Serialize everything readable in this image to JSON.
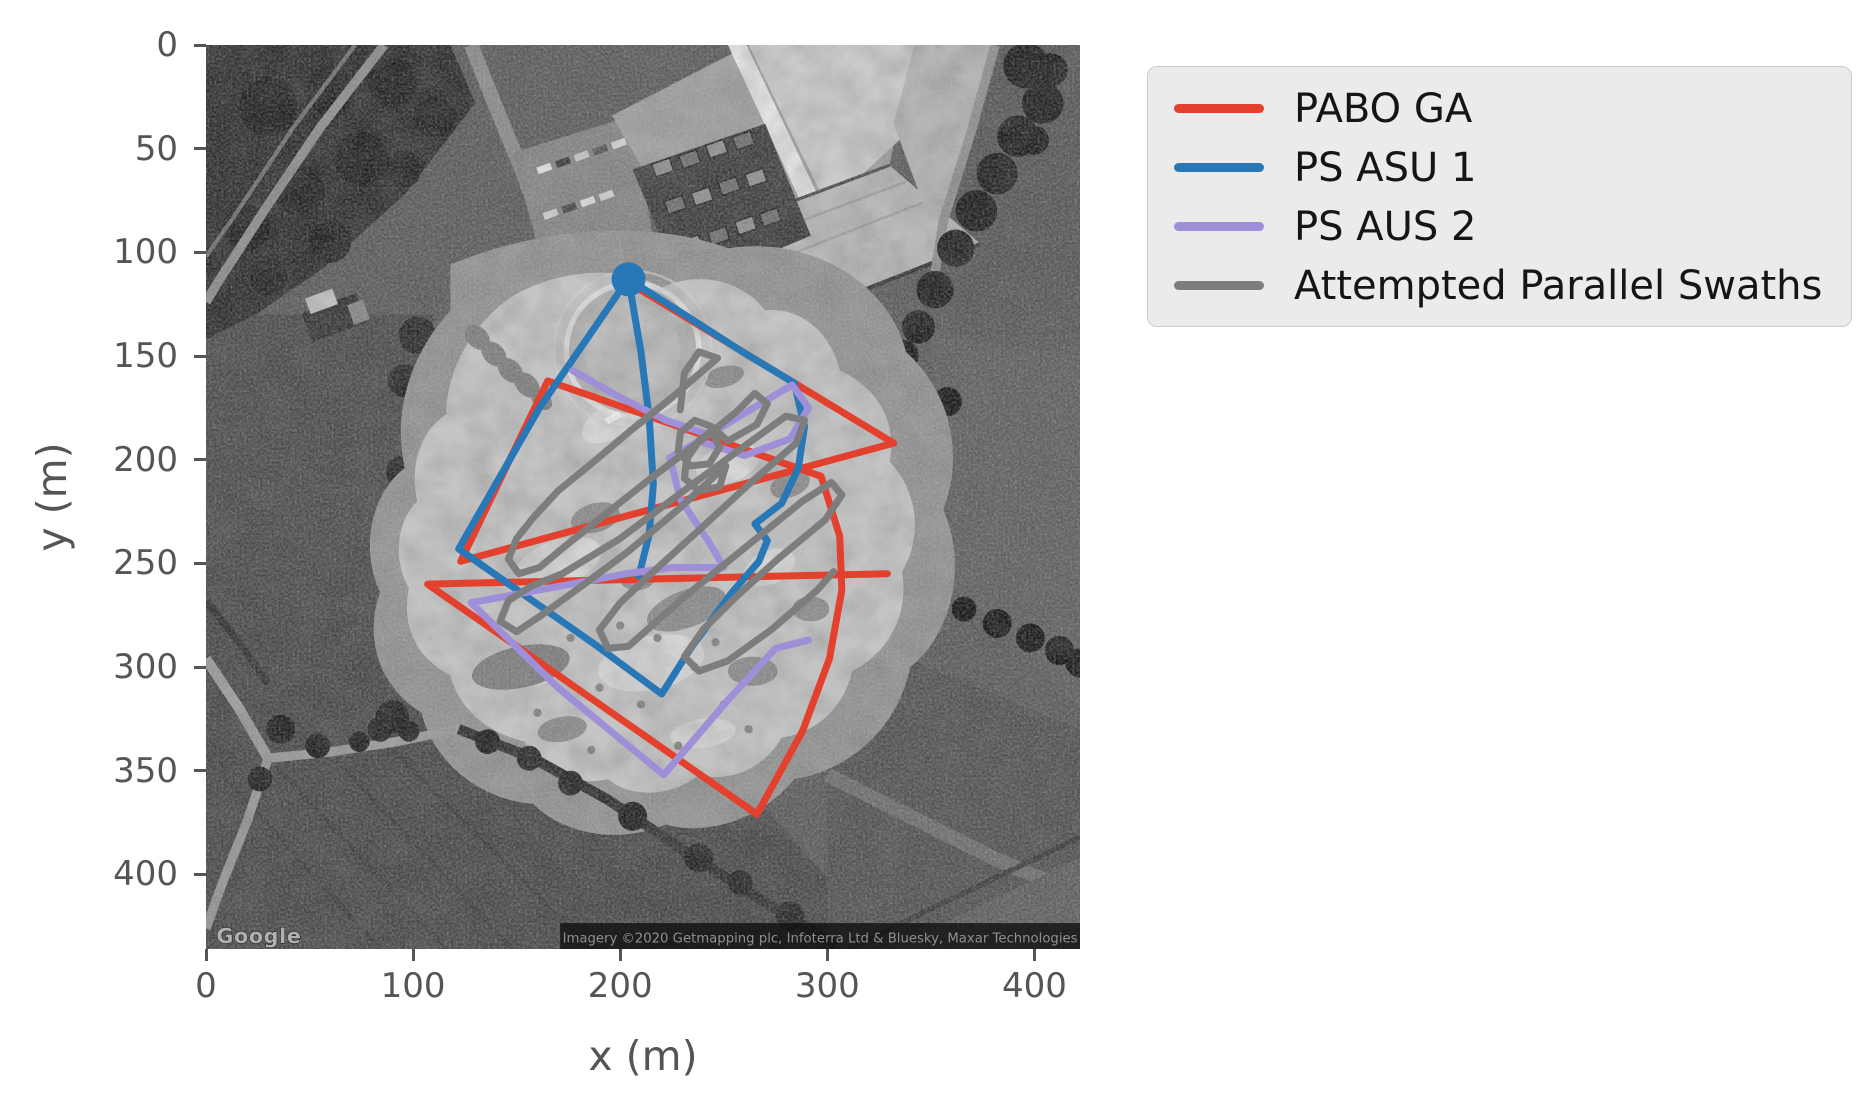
{
  "figure": {
    "background": "#ffffff",
    "axes": {
      "xlabel": "x (m)",
      "ylabel": "y (m)",
      "x_ticks": [
        0,
        100,
        200,
        300,
        400
      ],
      "y_ticks": [
        0,
        50,
        100,
        150,
        200,
        250,
        300,
        350,
        400
      ],
      "tick_color": "#555555",
      "tick_fontsize_px": 34,
      "axis_label_fontsize_px": 41
    }
  },
  "map_overlay": {
    "watermark": "Google",
    "attribution": "Imagery ©2020 Getmapping plc, Infoterra Ltd & Bluesky, Maxar Technologies"
  },
  "legend": {
    "background": "#ebebeb",
    "border_color": "#cccccc",
    "text_color": "#151515",
    "entries": [
      {
        "label": "PABO GA",
        "color": "#e3402e"
      },
      {
        "label": "PS ASU 1",
        "color": "#2878b8"
      },
      {
        "label": "PS AUS 2",
        "color": "#9f8fd8"
      },
      {
        "label": "Attempted Parallel Swaths",
        "color": "#7d7d7d"
      }
    ]
  },
  "chart_data": {
    "type": "line",
    "title": "",
    "xlabel": "x (m)",
    "ylabel": "y (m)",
    "xlim": [
      0,
      422
    ],
    "ylim": [
      0,
      436
    ],
    "y_axis_inverted": true,
    "grid": false,
    "legend_position": "outside upper right",
    "background": "grayscale satellite image of quarry test field (Google, Imagery ©2020)",
    "start_marker": {
      "series": "PS ASU 1",
      "x": 204,
      "y": 113,
      "radius_px": 17,
      "color": "#2878b8"
    },
    "series": [
      {
        "name": "PABO GA",
        "color": "#e3402e",
        "linewidth_px": 7,
        "points": [
          [
            203,
            114
          ],
          [
            332,
            192
          ],
          [
            123,
            249
          ],
          [
            165,
            162
          ],
          [
            297,
            208
          ],
          [
            306,
            237
          ],
          [
            307,
            263
          ],
          [
            301,
            296
          ],
          [
            288,
            331
          ],
          [
            266,
            371
          ],
          [
            107,
            260
          ],
          [
            329,
            255
          ]
        ]
      },
      {
        "name": "PS ASU 1",
        "color": "#2878b8",
        "linewidth_px": 7,
        "points": [
          [
            209,
            256
          ],
          [
            214,
            236
          ],
          [
            216,
            212
          ],
          [
            214,
            180
          ],
          [
            210,
            148
          ],
          [
            204,
            113
          ],
          [
            231,
            130
          ],
          [
            259,
            148
          ],
          [
            284,
            163
          ],
          [
            289,
            184
          ],
          [
            286,
            204
          ],
          [
            278,
            221
          ],
          [
            265,
            231
          ],
          [
            271,
            239
          ],
          [
            267,
            249
          ],
          [
            254,
            264
          ],
          [
            234,
            291
          ],
          [
            220,
            313
          ],
          [
            189,
            290
          ],
          [
            122,
            243
          ],
          [
            161,
            175
          ],
          [
            203,
            114
          ]
        ]
      },
      {
        "name": "PS AUS 2",
        "color": "#9f8fd8",
        "linewidth_px": 7,
        "points": [
          [
            177,
            157
          ],
          [
            200,
            170
          ],
          [
            222,
            181
          ],
          [
            243,
            188
          ],
          [
            266,
            174
          ],
          [
            283,
            164
          ],
          [
            291,
            175
          ],
          [
            282,
            190
          ],
          [
            260,
            198
          ],
          [
            238,
            191
          ],
          [
            224,
            199
          ],
          [
            229,
            219
          ],
          [
            243,
            240
          ],
          [
            250,
            252
          ],
          [
            225,
            252
          ],
          [
            203,
            255
          ],
          [
            128,
            269
          ],
          [
            170,
            310
          ],
          [
            221,
            352
          ],
          [
            252,
            316
          ],
          [
            275,
            291
          ],
          [
            291,
            287
          ]
        ]
      },
      {
        "name": "Attempted Parallel Swaths",
        "color": "#7d7d7d",
        "linewidth_px": 7,
        "points": [
          [
            229,
            176
          ],
          [
            231,
            158
          ],
          [
            238,
            148
          ],
          [
            247,
            151
          ],
          [
            225,
            170
          ],
          [
            205,
            186
          ],
          [
            186,
            202
          ],
          [
            170,
            215
          ],
          [
            158,
            228
          ],
          [
            150,
            238
          ],
          [
            146,
            248
          ],
          [
            151,
            255
          ],
          [
            161,
            252
          ],
          [
            173,
            242
          ],
          [
            192,
            227
          ],
          [
            216,
            208
          ],
          [
            240,
            190
          ],
          [
            256,
            177
          ],
          [
            265,
            168
          ],
          [
            271,
            173
          ],
          [
            266,
            183
          ],
          [
            252,
            191
          ],
          [
            244,
            184
          ],
          [
            236,
            181
          ],
          [
            229,
            187
          ],
          [
            228,
            196
          ],
          [
            234,
            203
          ],
          [
            243,
            202
          ],
          [
            248,
            194
          ],
          [
            244,
            186
          ],
          [
            238,
            191
          ],
          [
            232,
            200
          ],
          [
            231,
            209
          ],
          [
            238,
            215
          ],
          [
            248,
            213
          ],
          [
            251,
            203
          ],
          [
            228,
            224
          ],
          [
            203,
            245
          ],
          [
            180,
            262
          ],
          [
            162,
            275
          ],
          [
            150,
            283
          ],
          [
            142,
            278
          ],
          [
            146,
            268
          ],
          [
            157,
            261
          ],
          [
            172,
            255
          ],
          [
            200,
            238
          ],
          [
            232,
            214
          ],
          [
            262,
            192
          ],
          [
            280,
            179
          ],
          [
            289,
            181
          ],
          [
            285,
            192
          ],
          [
            262,
            212
          ],
          [
            238,
            234
          ],
          [
            216,
            254
          ],
          [
            200,
            269
          ],
          [
            190,
            282
          ],
          [
            194,
            291
          ],
          [
            204,
            290
          ],
          [
            230,
            267
          ],
          [
            262,
            241
          ],
          [
            288,
            220
          ],
          [
            302,
            211
          ],
          [
            307,
            217
          ],
          [
            299,
            229
          ],
          [
            276,
            248
          ],
          [
            255,
            267
          ],
          [
            240,
            282
          ],
          [
            231,
            295
          ],
          [
            238,
            302
          ],
          [
            252,
            297
          ],
          [
            273,
            282
          ],
          [
            295,
            263
          ],
          [
            303,
            254
          ]
        ]
      }
    ]
  }
}
